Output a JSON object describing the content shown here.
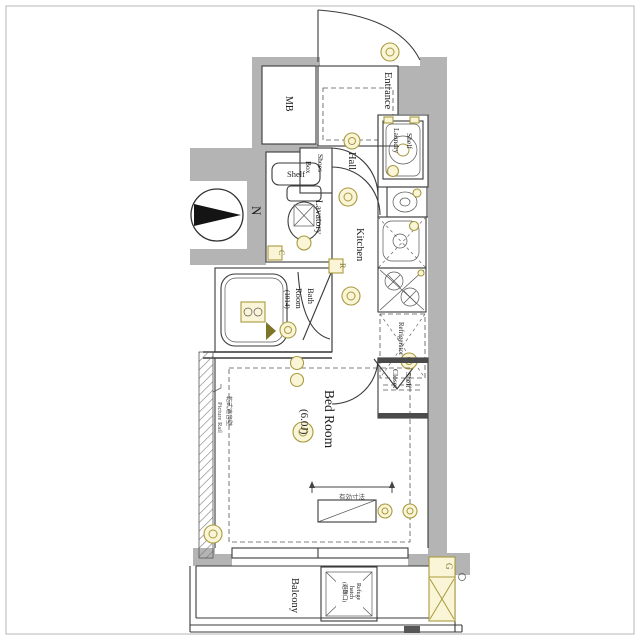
{
  "palette": {
    "wall": "#b4b4b4",
    "line": "#3a3a3a",
    "accent": "#a89a3e",
    "accent_fill": "#faf5d7",
    "accent_dark": "#7e7428",
    "text": "#1b1b1b",
    "frame": "#cfcfcf"
  },
  "compass": {
    "north_label": "N"
  },
  "rooms": {
    "mb": {
      "label": "MB"
    },
    "entrance": {
      "label": "Entrance"
    },
    "hall": {
      "label": "Hall"
    },
    "shoes_box": {
      "line1": "Shoes",
      "line2": "Box"
    },
    "laundry": {
      "line1": "Shelf",
      "line2": "Laundry"
    },
    "lavatory": {
      "label": "Lavatory",
      "shelf": "Shelf"
    },
    "kitchen": {
      "label": "Kitchen"
    },
    "refrigerator": {
      "label": "Refrigerator"
    },
    "bath": {
      "line1": "Bath",
      "line2": "Room",
      "line3": "(1014)"
    },
    "closet": {
      "line1": "Shelf",
      "line2": "Closet"
    },
    "bedroom": {
      "line1": "Bed Room",
      "line2": "(6.0J)"
    },
    "balcony": {
      "label": "Balcony"
    },
    "refuge_hatch": {
      "line1": "Refuge",
      "line2": "hatch",
      "line3": "(避難口)"
    }
  },
  "annotations": {
    "picture_rail": "Picture Rail",
    "wall_note": "乾式遮音壁",
    "dimension_note": "有効寸法",
    "meter_c": "C",
    "meter_r": "R",
    "meter_g": "G"
  }
}
